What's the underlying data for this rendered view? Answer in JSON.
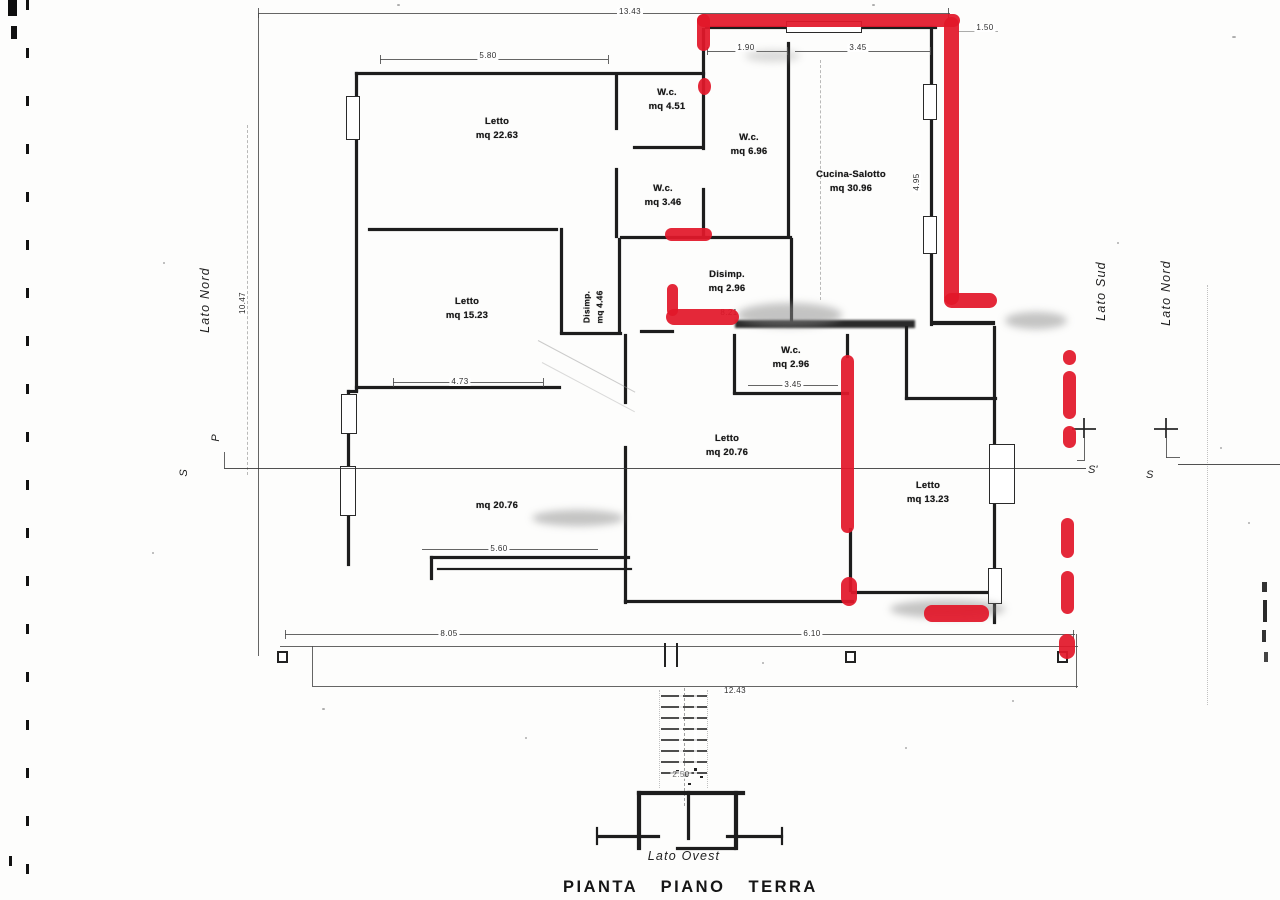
{
  "title": "PIANTA PIANO TERRA",
  "side_labels": {
    "left": "Lato Nord",
    "right_inner": "Lato Sud",
    "right_outer": "Lato Nord",
    "bottom": "Lato Ovest"
  },
  "section_markers": {
    "p": "P",
    "s_left": "S",
    "s_prime": "S'",
    "s_right": "S"
  },
  "rooms": [
    {
      "name": "Letto",
      "area": "mq 22.63"
    },
    {
      "name": "W.c.",
      "area": "mq 4.51"
    },
    {
      "name": "W.c.",
      "area": "mq 3.46"
    },
    {
      "name": "W.c.",
      "area": "mq 6.96"
    },
    {
      "name": "Cucina-Salotto",
      "area": "mq 30.96"
    },
    {
      "name": "Disimp.",
      "area": "mq 2.96"
    },
    {
      "name": "Disimp.",
      "area": "mq 4.46"
    },
    {
      "name": "Letto",
      "area": "mq 15.23"
    },
    {
      "name": "W.c.",
      "area": "mq 2.96"
    },
    {
      "name": "Letto",
      "area": "mq 20.76"
    },
    {
      "name": "",
      "area": "mq 20.76"
    },
    {
      "name": "Letto",
      "area": "mq 13.23"
    }
  ],
  "dims": [
    {
      "value": "13.43"
    },
    {
      "value": "5.80"
    },
    {
      "value": "1.90"
    },
    {
      "value": "3.45"
    },
    {
      "value": "1.50"
    },
    {
      "value": "10.47"
    },
    {
      "value": "4.95"
    },
    {
      "value": "8.21"
    },
    {
      "value": "4.73"
    },
    {
      "value": "3.45"
    },
    {
      "value": "5.60"
    },
    {
      "value": "8.05"
    },
    {
      "value": "6.10"
    },
    {
      "value": "12.43"
    },
    {
      "value": "2.50"
    }
  ],
  "colors": {
    "marker_red": "#e2182a",
    "ink": "#1d1d1d",
    "paper": "#fdfdfc"
  }
}
